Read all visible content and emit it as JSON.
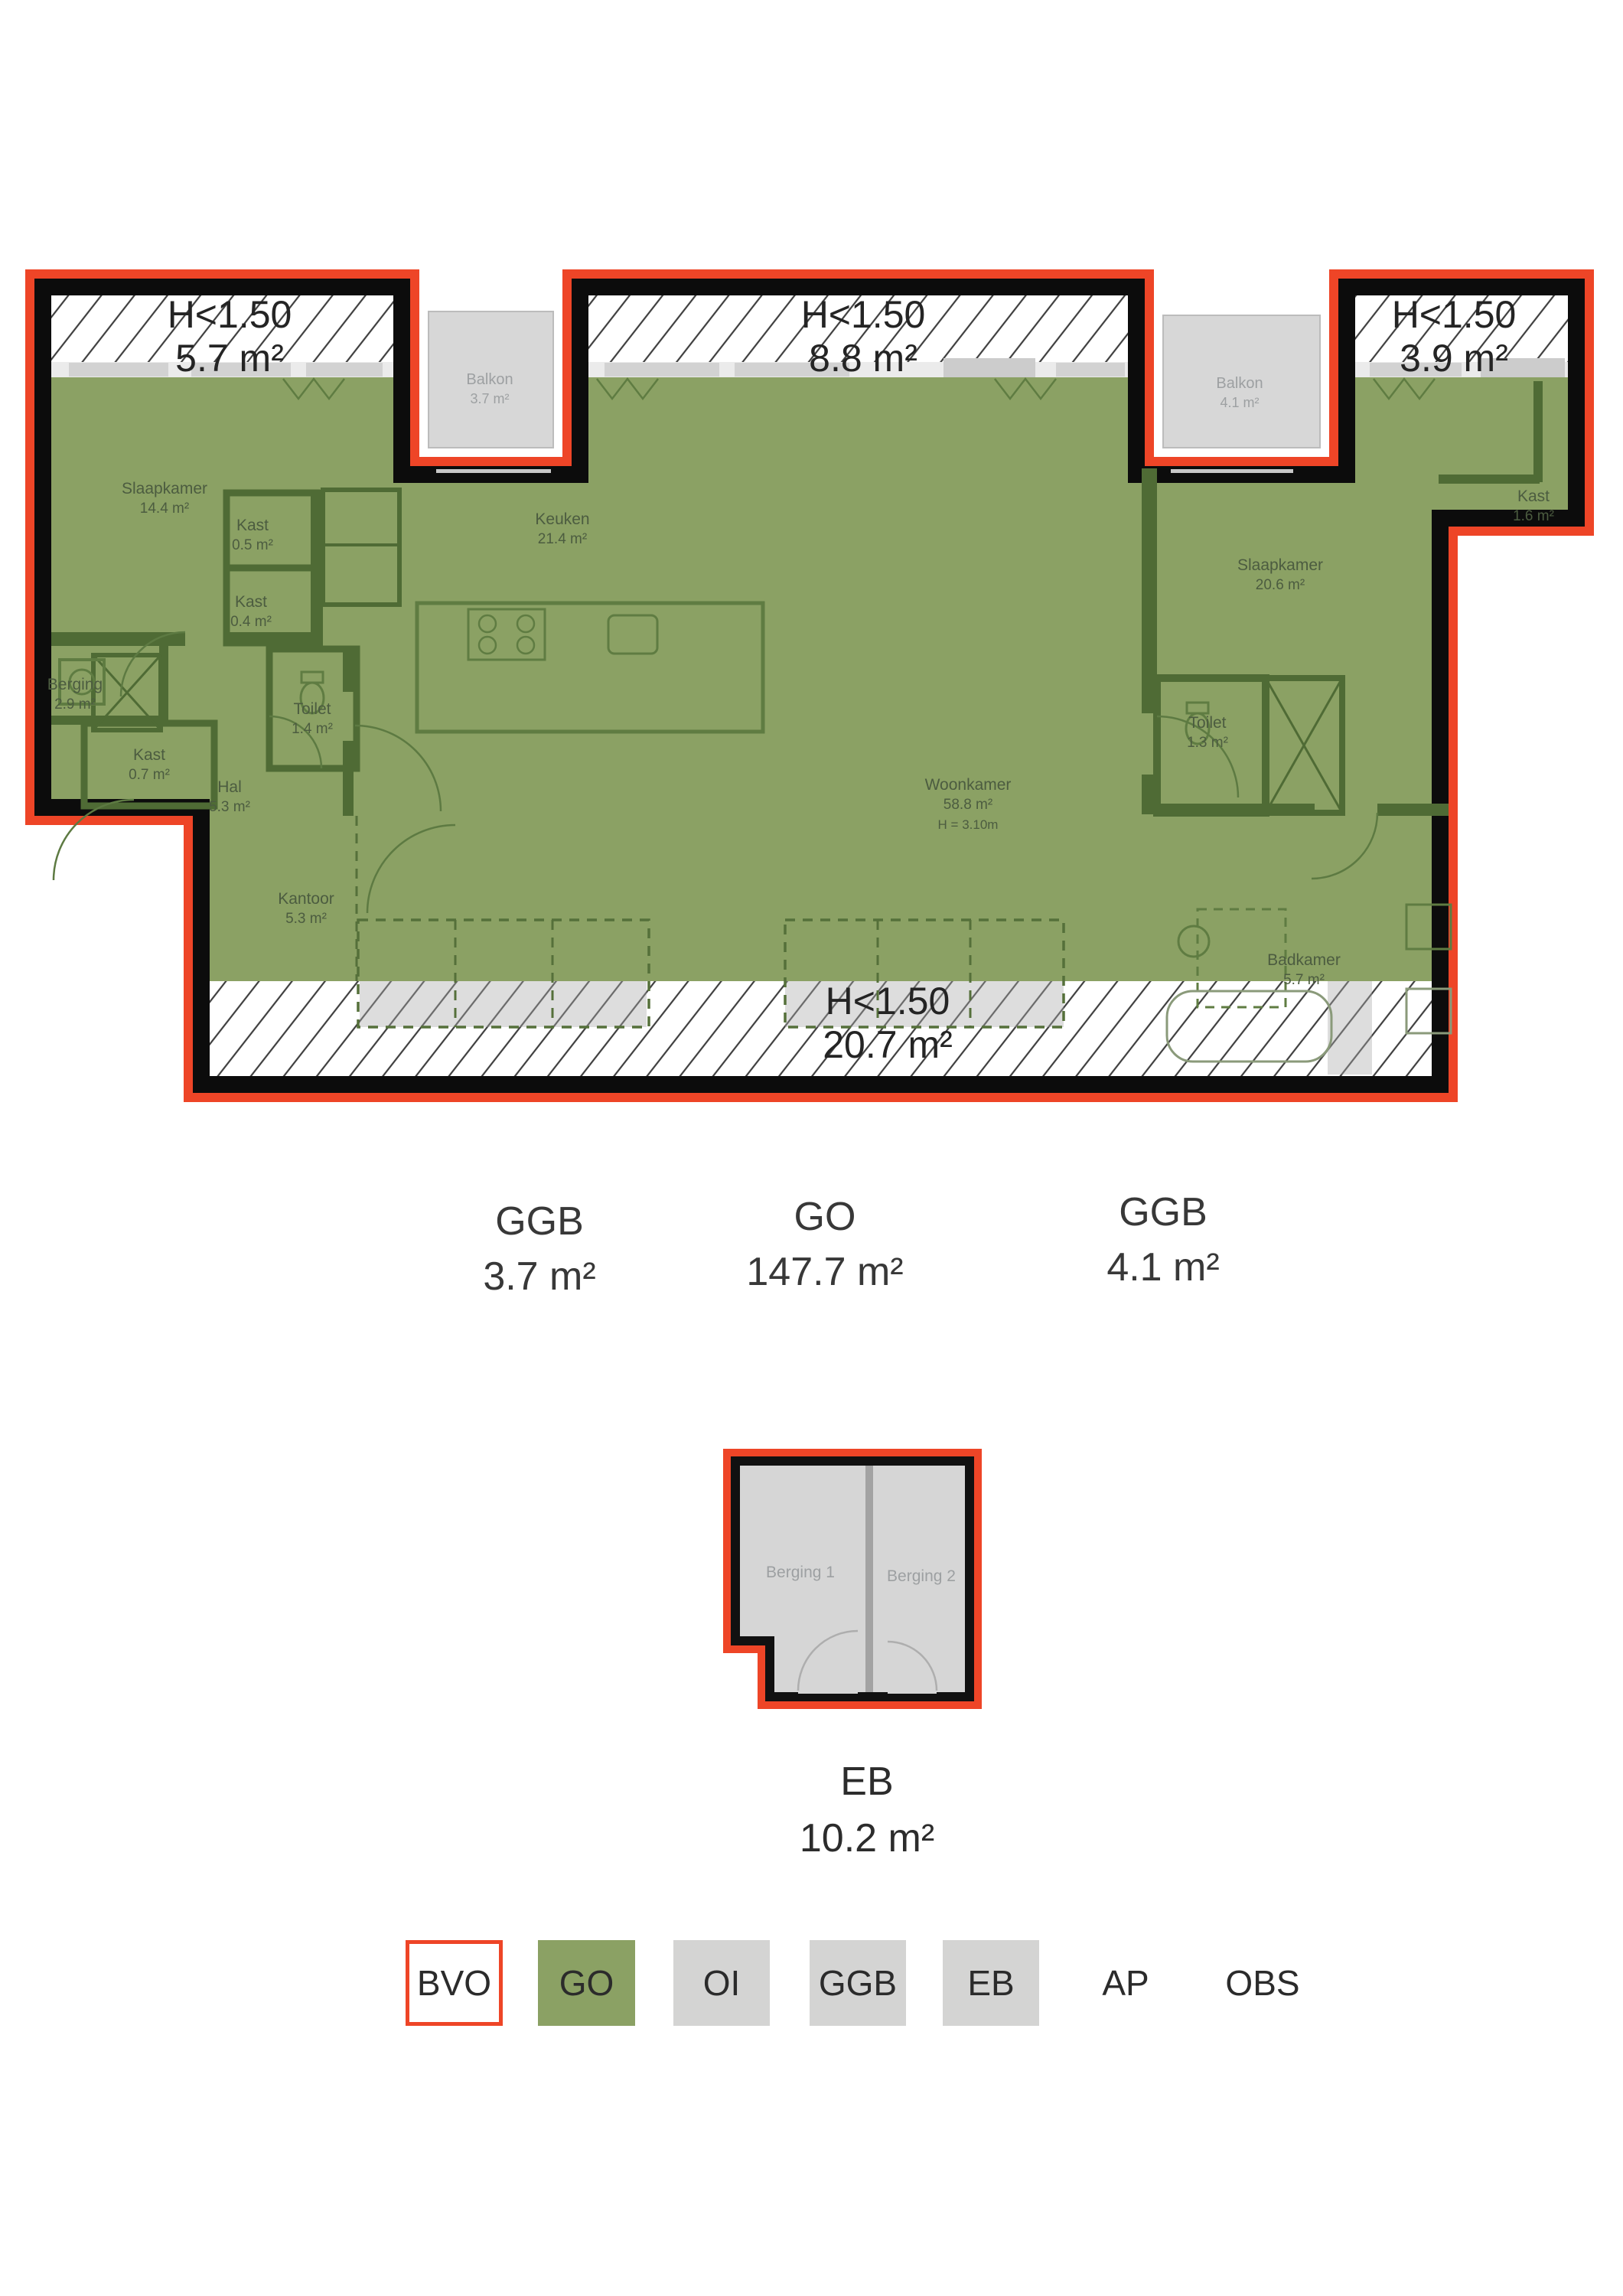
{
  "plan": {
    "low_height_zones": [
      {
        "label": "H<1.50",
        "area": "5.7 m²"
      },
      {
        "label": "H<1.50",
        "area": "8.8 m²"
      },
      {
        "label": "H<1.50",
        "area": "3.9 m²"
      },
      {
        "label": "H<1.50",
        "area": "20.7 m²"
      }
    ],
    "balconies": [
      {
        "name": "Balkon",
        "area": "3.7 m²"
      },
      {
        "name": "Balkon",
        "area": "4.1 m²"
      }
    ],
    "rooms": [
      {
        "name": "Slaapkamer",
        "area": "14.4 m²"
      },
      {
        "name": "Kast",
        "area": "0.5 m²"
      },
      {
        "name": "Kast",
        "area": "0.4 m²"
      },
      {
        "name": "Keuken",
        "area": "21.4 m²"
      },
      {
        "name": "Berging",
        "area": "2.9 m²"
      },
      {
        "name": "Kast",
        "area": "0.7 m²"
      },
      {
        "name": "Toilet",
        "area": "1.4 m²"
      },
      {
        "name": "Hal",
        "area": "5.3 m²"
      },
      {
        "name": "Kantoor",
        "area": "5.3 m²"
      },
      {
        "name": "Woonkamer",
        "area": "58.8 m²",
        "height_note": "H = 3.10m"
      },
      {
        "name": "Slaapkamer",
        "area": "20.6 m²"
      },
      {
        "name": "Kast",
        "area": "1.6 m²"
      },
      {
        "name": "Toilet",
        "area": "1.3 m²"
      },
      {
        "name": "Badkamer",
        "area": "5.7 m²"
      }
    ]
  },
  "area_summary": [
    {
      "label": "GGB",
      "value": "3.7 m²"
    },
    {
      "label": "GO",
      "value": "147.7 m²"
    },
    {
      "label": "GGB",
      "value": "4.1 m²"
    }
  ],
  "storage_plan": {
    "rooms": [
      {
        "name": "Berging 1"
      },
      {
        "name": "Berging 2"
      }
    ],
    "label": "EB",
    "value": "10.2 m²"
  },
  "legend": {
    "items": [
      {
        "label": "BVO"
      },
      {
        "label": "GO"
      },
      {
        "label": "OI"
      },
      {
        "label": "GGB"
      },
      {
        "label": "EB"
      },
      {
        "label": "AP"
      },
      {
        "label": "OBS"
      }
    ]
  },
  "colors": {
    "outline_red": "#ee4527",
    "go_green": "#8ba164",
    "gray_fill": "#d5d5d5",
    "wall_black": "#0c0c0c",
    "wall_olive": "#4f6b35",
    "hatch_line": "#3e3e3e"
  }
}
